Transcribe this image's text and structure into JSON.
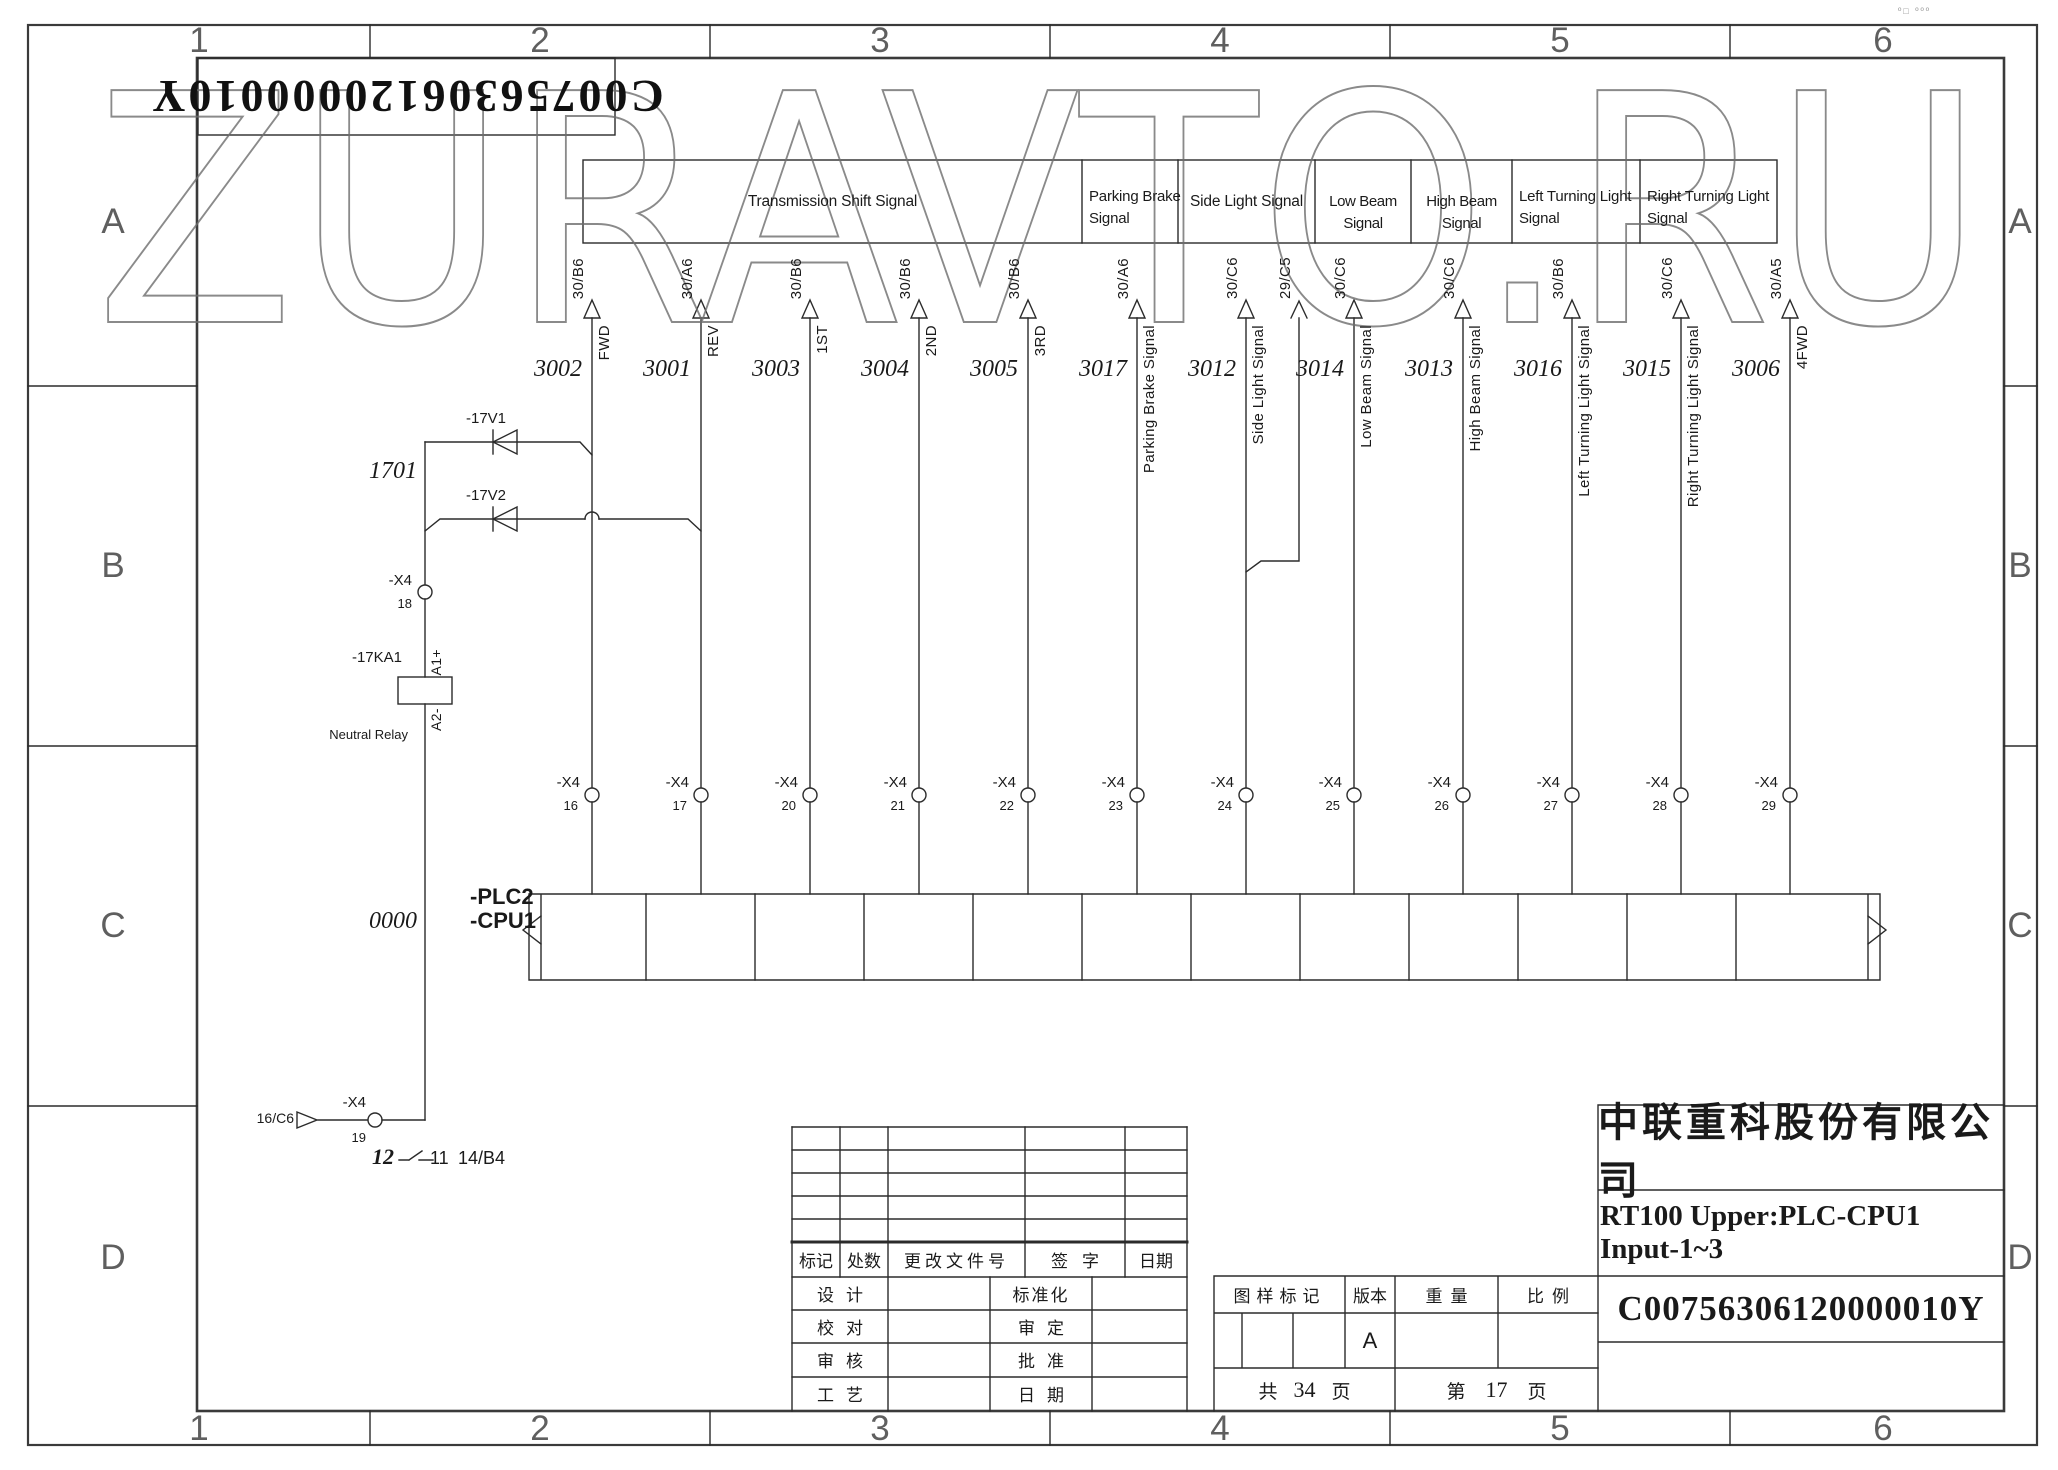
{
  "watermark": "ZURAVTO.RU",
  "corner_marks": "º□ ººº",
  "rotated_doc_number": "C00756306120000010Y",
  "frame": {
    "columns": [
      "1",
      "2",
      "3",
      "4",
      "5",
      "6"
    ],
    "rows": [
      "A",
      "B",
      "C",
      "D"
    ]
  },
  "signal_groups": {
    "transmission": "Transmission Shift Signal",
    "parking_brake": "Parking Brake Signal",
    "side_light": "Side Light Signal",
    "low_beam": "Low Beam Signal",
    "high_beam": "High Beam Signal",
    "left_turning": "Left Turning Light Signal",
    "right_turning": "Right Turning Light Signal"
  },
  "offpage_ref": "29/C5",
  "connector_name": "-X4",
  "wires": [
    {
      "number": "3002",
      "ref": "30/B6",
      "name": "FWD",
      "pin": "16"
    },
    {
      "number": "3001",
      "ref": "30/A6",
      "name": "REV",
      "pin": "17"
    },
    {
      "number": "3003",
      "ref": "30/B6",
      "name": "1ST",
      "pin": "20"
    },
    {
      "number": "3004",
      "ref": "30/B6",
      "name": "2ND",
      "pin": "21"
    },
    {
      "number": "3005",
      "ref": "30/B6",
      "name": "3RD",
      "pin": "22"
    },
    {
      "number": "3017",
      "ref": "30/A6",
      "name": "Parking Brake Signal",
      "pin": "23"
    },
    {
      "number": "3012",
      "ref": "30/C6",
      "name": "Side Light Signal",
      "pin": "24"
    },
    {
      "number": "3014",
      "ref": "30/C6",
      "name": "Low Beam Signal",
      "pin": "25"
    },
    {
      "number": "3013",
      "ref": "30/C6",
      "name": "High Beam Signal",
      "pin": "26"
    },
    {
      "number": "3016",
      "ref": "30/B6",
      "name": "Left Turning Light Signal",
      "pin": "27"
    },
    {
      "number": "3015",
      "ref": "30/C6",
      "name": "Right Turning Light Signal",
      "pin": "28"
    },
    {
      "number": "3006",
      "ref": "30/A5",
      "name": "4FWD",
      "pin": "29"
    }
  ],
  "relay_circuit": {
    "net_in": "1701",
    "diode_top": "-17V1",
    "diode_bottom": "-17V2",
    "connector": "-X4",
    "pin": "18",
    "relay": "-17KA1",
    "coil_top": "A1+",
    "coil_bottom": "A2-",
    "caption": "Neutral Relay",
    "net_out": "0000",
    "connector_out": "-X4",
    "pin_out": "19",
    "source_ref": "16/C6",
    "contact_a": "12",
    "contact_b": "11",
    "contact_ref": "14/B4"
  },
  "plc": {
    "line1": "-PLC2",
    "line2": "-CPU1"
  },
  "title_block": {
    "company": "中联重科股份有限公司",
    "drawing_title": "RT100 Upper:PLC-CPU1 Input-1~3",
    "drawing_number": "C00756306120000010Y",
    "rev_headers": [
      "标记",
      "处数",
      "更改文件号",
      "签字",
      "日期"
    ],
    "sign_left": [
      "设计",
      "校对",
      "审核",
      "工艺"
    ],
    "sign_right": [
      "标准化",
      "审定",
      "批准",
      "日期"
    ],
    "stamp_headers": [
      "图样标记",
      "版本",
      "重量",
      "比例"
    ],
    "version": "A",
    "pages": {
      "total_prefix": "共",
      "total": "34",
      "unit": "页",
      "page_prefix": "第",
      "page": "17"
    }
  }
}
